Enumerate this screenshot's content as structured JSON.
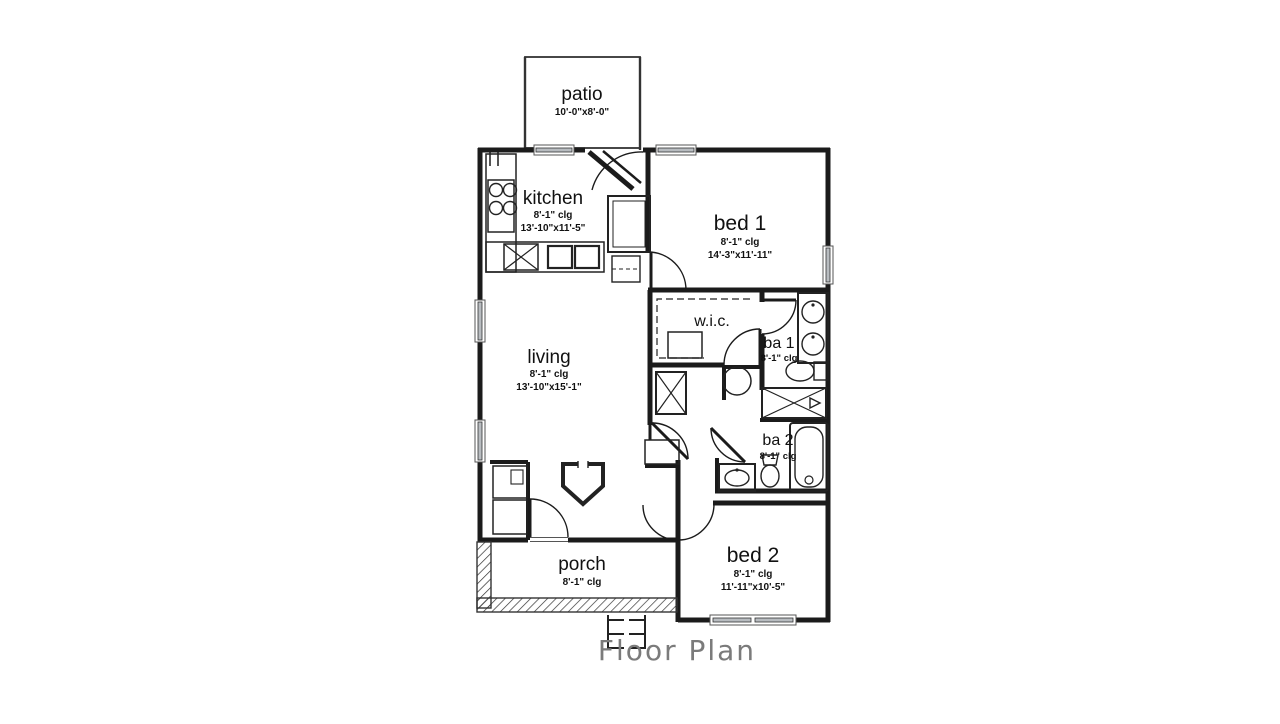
{
  "title": "Floor Plan",
  "rooms": {
    "patio": {
      "name": "patio",
      "dims": "10'-0\"x8'-0\""
    },
    "kitchen": {
      "name": "kitchen",
      "clg": "8'-1\" clg",
      "dims": "13'-10\"x11'-5\""
    },
    "bed1": {
      "name": "bed 1",
      "clg": "8'-1\" clg",
      "dims": "14'-3\"x11'-11\""
    },
    "living": {
      "name": "living",
      "clg": "8'-1\" clg",
      "dims": "13'-10\"x15'-1\""
    },
    "wic": {
      "name": "w.i.c."
    },
    "ba1": {
      "name": "ba 1",
      "clg": "8'-1\" clg"
    },
    "ba2": {
      "name": "ba 2",
      "clg": "8'-1\" clg"
    },
    "bed2": {
      "name": "bed 2",
      "clg": "8'-1\" clg",
      "dims": "11'-11\"x10'-5\""
    },
    "porch": {
      "name": "porch",
      "clg": "8'-1\" clg"
    }
  },
  "colors": {
    "wall": "#1b1b1b",
    "window_fill": "#b8bcc0",
    "label_text": "#111111",
    "title_text": "#7b7b7b"
  }
}
